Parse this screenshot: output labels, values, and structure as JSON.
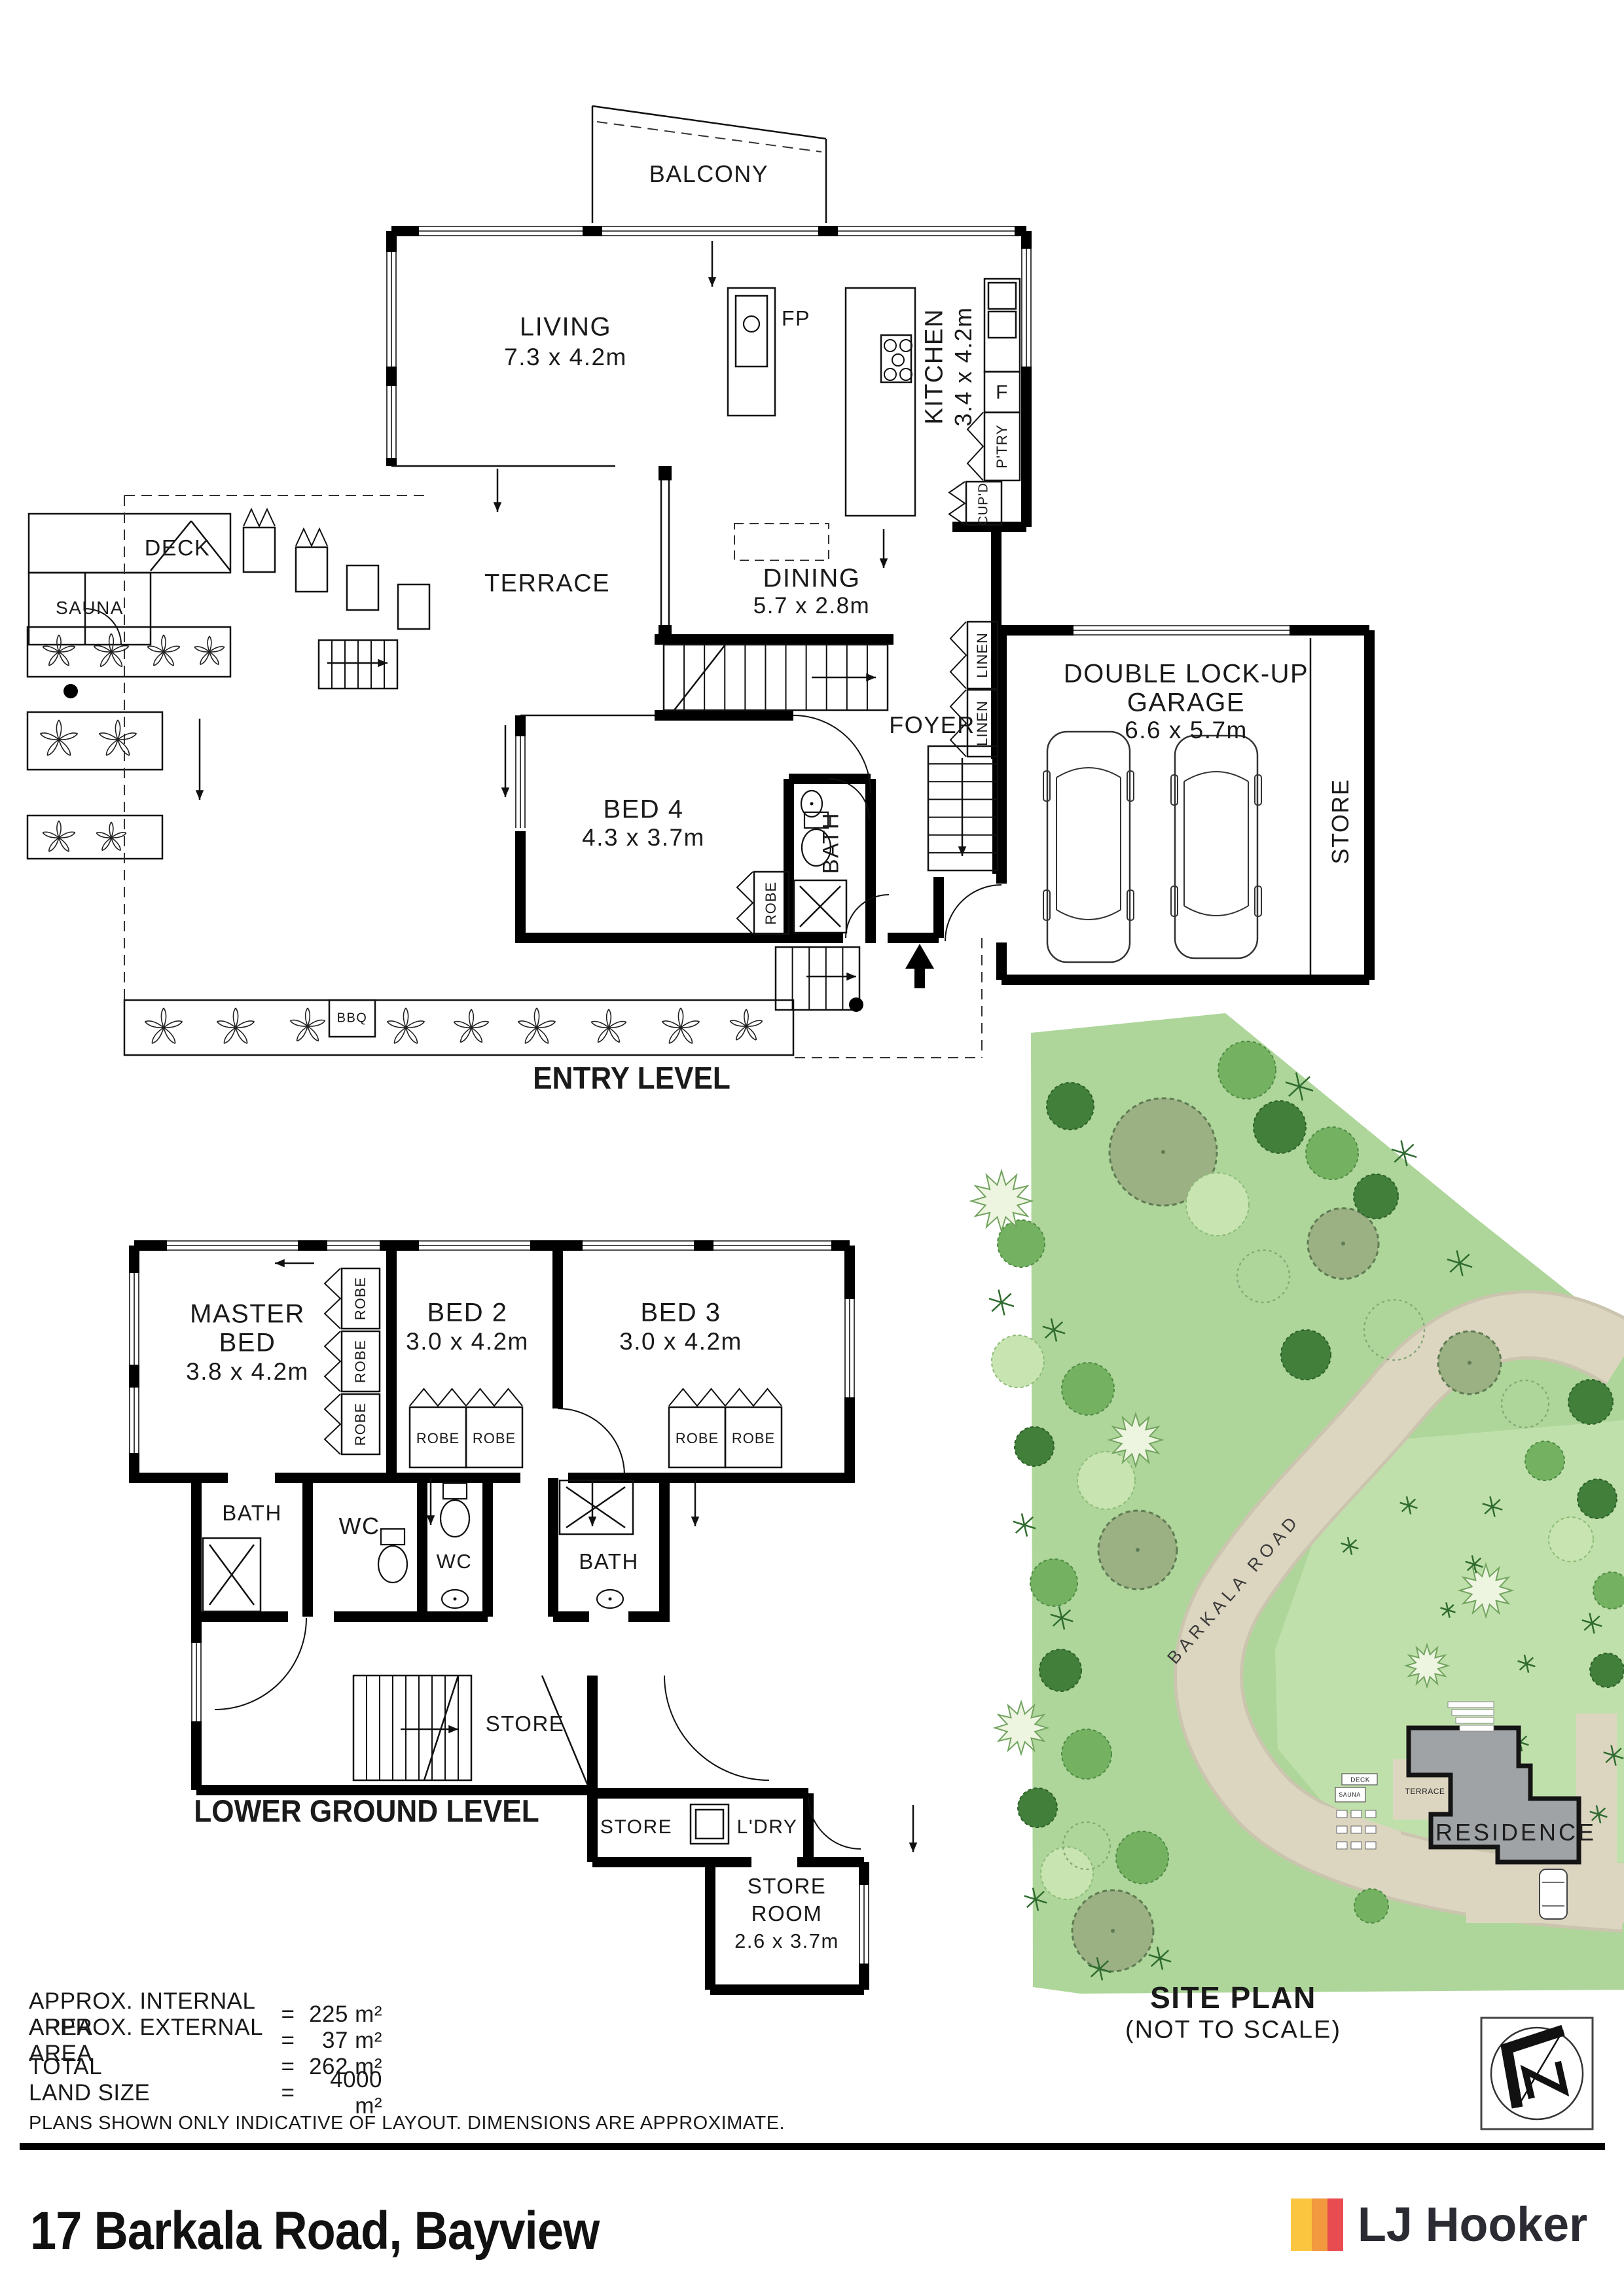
{
  "entry_level": {
    "title": "ENTRY LEVEL",
    "rooms": {
      "balcony": "BALCONY",
      "living": {
        "name": "LIVING",
        "dims": "7.3 x 4.2m"
      },
      "kitchen": {
        "name": "KITCHEN",
        "dims": "3.4 x 4.2m"
      },
      "dining": {
        "name": "DINING",
        "dims": "5.7 x 2.8m"
      },
      "terrace": "TERRACE",
      "deck": "DECK",
      "sauna": "SAUNA",
      "bed4": {
        "name": "BED 4",
        "dims": "4.3 x 3.7m"
      },
      "foyer": "FOYER",
      "bath": "BATH",
      "garage": {
        "line1": "DOUBLE LOCK-UP",
        "line2": "GARAGE",
        "dims": "6.6 x 5.7m"
      },
      "store": "STORE"
    },
    "small_labels": {
      "fireplace": "FP",
      "fridge": "F",
      "pantry": "P'TRY",
      "cupboard": "CUP'D",
      "linen": "LINEN",
      "robe": "ROBE",
      "bbq": "BBQ"
    }
  },
  "lower_ground": {
    "title": "LOWER GROUND LEVEL",
    "rooms": {
      "master": {
        "line1": "MASTER",
        "line2": "BED",
        "dims": "3.8 x 4.2m"
      },
      "bed2": {
        "name": "BED 2",
        "dims": "3.0 x 4.2m"
      },
      "bed3": {
        "name": "BED 3",
        "dims": "3.0 x 4.2m"
      },
      "bath": "BATH",
      "wc": "WC",
      "store": "STORE",
      "laundry": "L'DRY",
      "store_room": {
        "line1": "STORE",
        "line2": "ROOM",
        "dims": "2.6 x 3.7m"
      },
      "robe": "ROBE"
    }
  },
  "site_plan": {
    "title": "SITE PLAN",
    "subtitle": "(NOT TO SCALE)",
    "road": "BARKALA ROAD",
    "residence": "RESIDENCE",
    "terrace": "TERRACE",
    "deck": "DECK",
    "sauna": "SAUNA"
  },
  "areas": {
    "rows": [
      {
        "label": "APPROX. INTERNAL AREA",
        "eq": "=",
        "value": "225 m²"
      },
      {
        "label": "APPROX. EXTERNAL AREA",
        "eq": "=",
        "value": "37 m²"
      },
      {
        "label": "TOTAL",
        "eq": "=",
        "value": "262 m²"
      },
      {
        "label": "LAND SIZE",
        "eq": "=",
        "value": "4000 m²"
      }
    ],
    "disclaimer": "PLANS SHOWN ONLY INDICATIVE OF LAYOUT.  DIMENSIONS ARE APPROXIMATE."
  },
  "footer": {
    "address": "17 Barkala Road, Bayview",
    "brand": "LJ Hooker"
  },
  "colors": {
    "logo_yellow": "#FBC540",
    "logo_orange": "#F2983E",
    "logo_red": "#E84C50",
    "site_green": "#AED69A",
    "site_green_inner": "#C0E0AB",
    "road_beige": "#DCD6C1",
    "residence_grey": "#9FA3A6"
  }
}
